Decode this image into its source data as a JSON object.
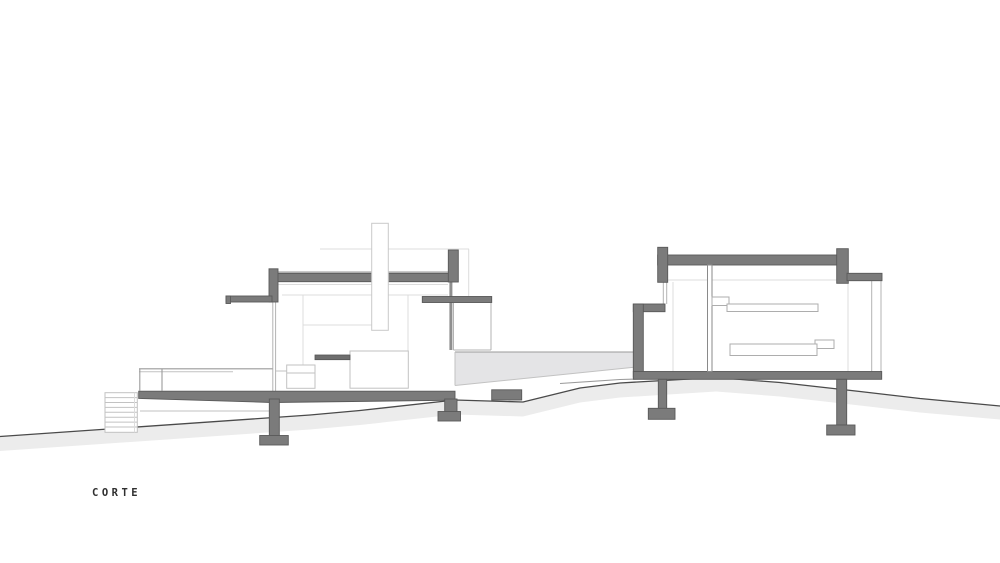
{
  "title_label": "CORTE",
  "drawing": {
    "kind": "architectural-section-drawing",
    "label": "CORTE",
    "elements": [
      "terrain",
      "stair",
      "deck",
      "deck-railing",
      "left-pavilion",
      "chimney",
      "kitchen-island",
      "link-canopy",
      "patio-terrace",
      "right-pavilion",
      "wall-shelves",
      "columns",
      "footings"
    ],
    "colors": {
      "background": "#ffffff",
      "cut_fill": "#7b7b7b",
      "cut_outline": "#595959",
      "terrain_line": "#4a4a4a",
      "earth_fill": "#ececec",
      "patio_fill": "#e4e4e6",
      "glass_line": "#b3b3b3",
      "light_line": "#c2c2c2",
      "faint_line": "#dcdcdc",
      "label_color": "#2f2f2f"
    }
  }
}
